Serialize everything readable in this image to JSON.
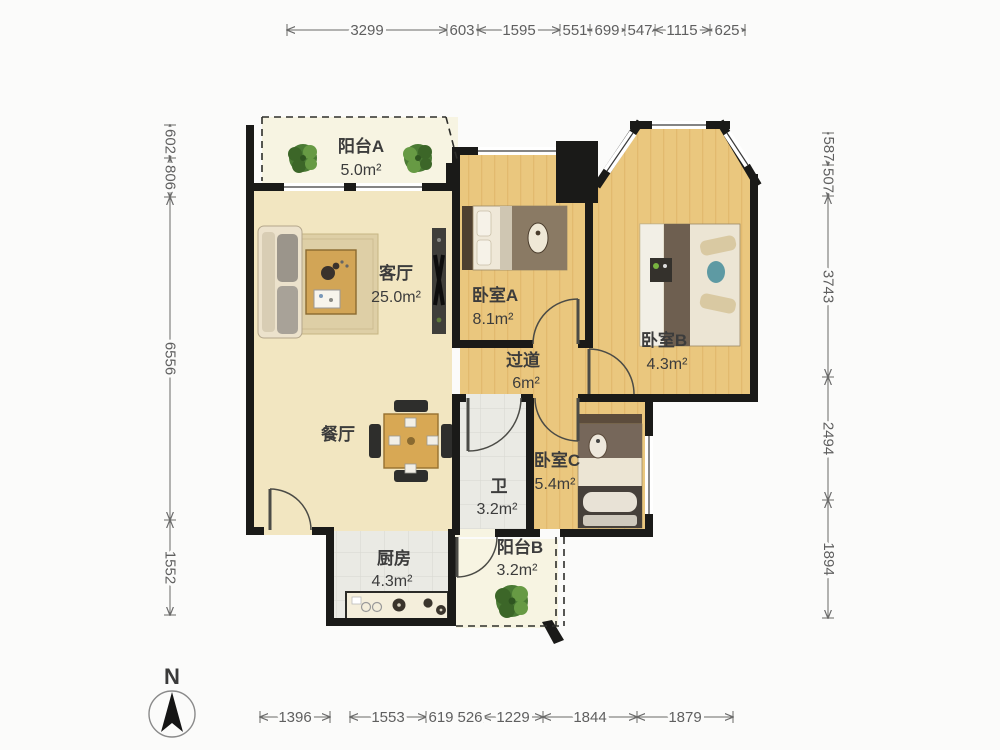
{
  "plan": {
    "north_label": "N",
    "rooms": [
      {
        "id": "balcony-a",
        "name": "阳台A",
        "area": "5.0m²"
      },
      {
        "id": "living-room",
        "name": "客厅",
        "area": "25.0m²"
      },
      {
        "id": "dining-room",
        "name": "餐厅",
        "area": ""
      },
      {
        "id": "bedroom-a",
        "name": "卧室A",
        "area": "8.1m²"
      },
      {
        "id": "bedroom-b",
        "name": "卧室B",
        "area": "4.3m²"
      },
      {
        "id": "hallway",
        "name": "过道",
        "area": "6m²"
      },
      {
        "id": "bathroom",
        "name": "卫",
        "area": "3.2m²"
      },
      {
        "id": "bedroom-c",
        "name": "卧室C",
        "area": "5.4m²"
      },
      {
        "id": "kitchen",
        "name": "厨房",
        "area": "4.3m²"
      },
      {
        "id": "balcony-b",
        "name": "阳台B",
        "area": "3.2m²"
      }
    ]
  },
  "dimensions": {
    "top": [
      "3299",
      "603",
      "1595",
      "551",
      "699",
      "547",
      "1115",
      "625"
    ],
    "bottom": [
      "1396",
      "1553",
      "619",
      "526",
      "1229",
      "1844",
      "1879"
    ],
    "left": [
      "602",
      "806",
      "6556",
      "1552"
    ],
    "right": [
      "587",
      "507",
      "3743",
      "2494",
      "1894"
    ]
  },
  "colors": {
    "wall": "#1a1a18",
    "wood_floor": "#eac77e",
    "wood_grain": "#d7a95c",
    "tile_floor": "#eaeae4",
    "tile_line": "#d7d7d0",
    "living_floor": "#f2e6c1",
    "balcony_floor": "#f7f4e2",
    "plant": "#4a7a34",
    "dim": "#6a6a66"
  }
}
